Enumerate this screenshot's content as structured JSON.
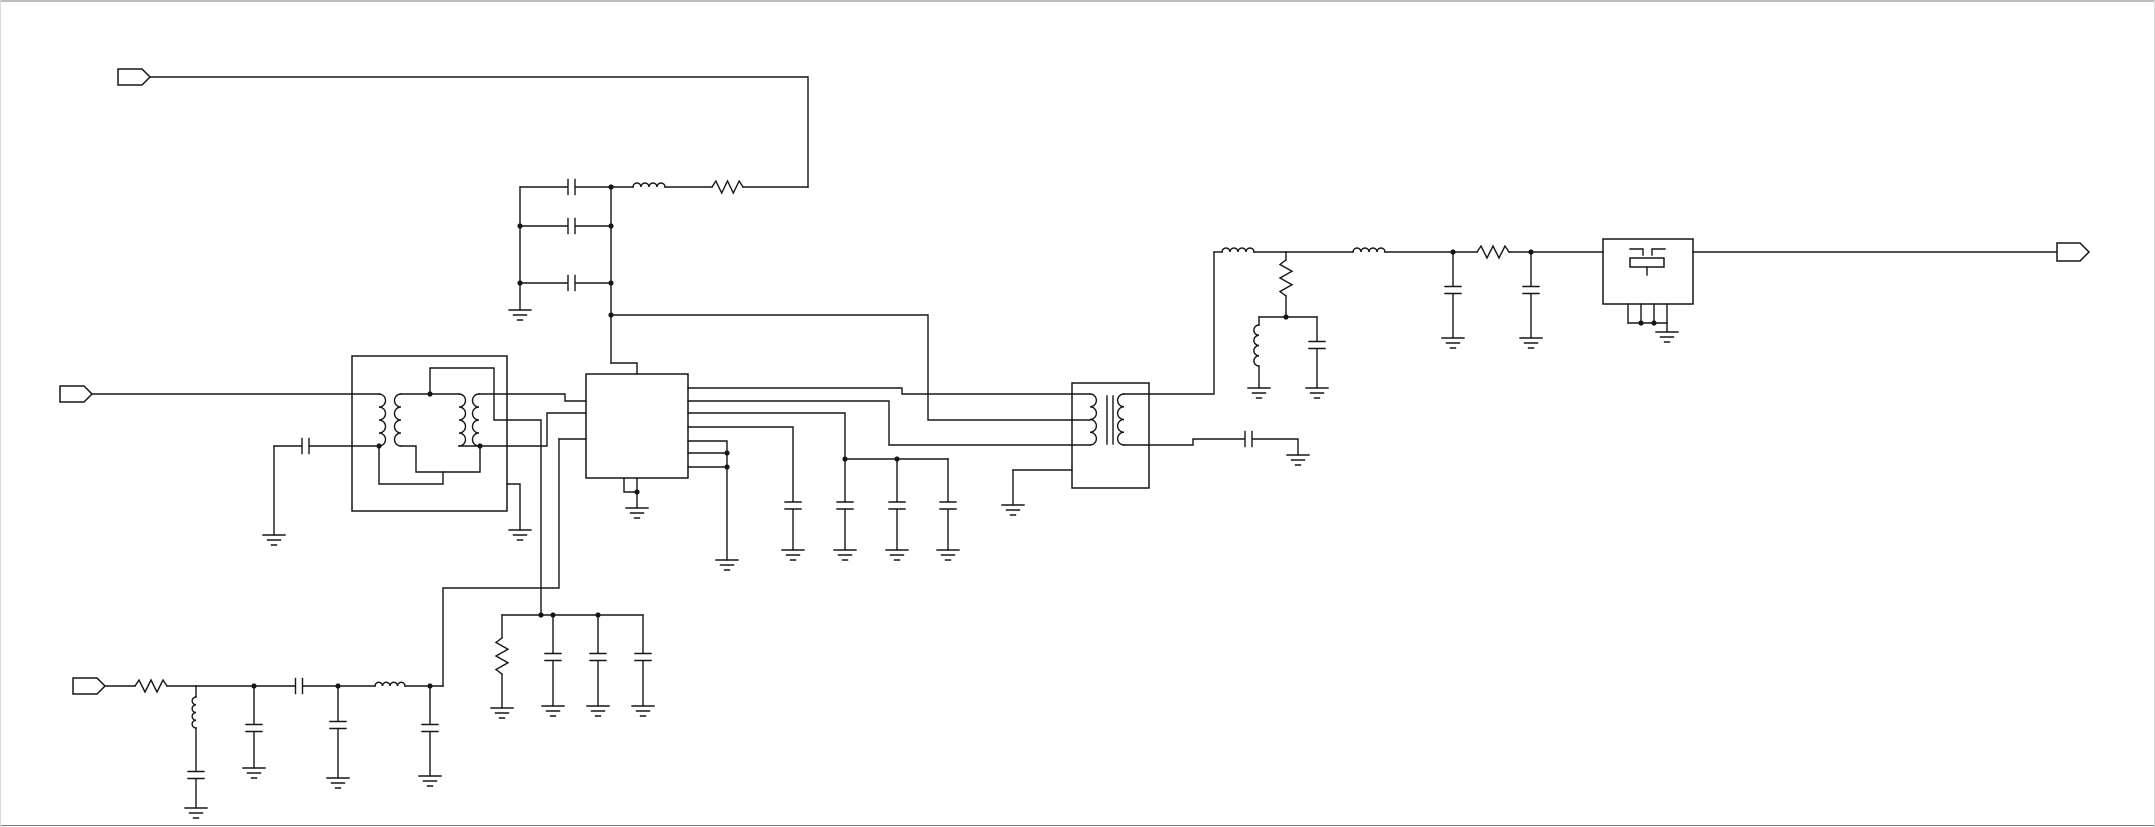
{
  "canvas": {
    "width": 2155,
    "height": 827,
    "background": "#ffffff",
    "line_color": "#161616"
  },
  "frame": {
    "top_color": "#7a7a7a",
    "bottom_color": "#7a7a7a",
    "side_color": "#d8d8d8",
    "lines": [
      {
        "name": "window-top-edge",
        "x1": 0,
        "y1": 1,
        "x2": 2155,
        "y2": 1,
        "color": "#7a7a7a"
      },
      {
        "name": "window-bottom-edge",
        "x1": 0,
        "y1": 825.5,
        "x2": 2155,
        "y2": 825.5,
        "color": "#7a7a7a"
      },
      {
        "name": "window-left-edge",
        "x1": 0.5,
        "y1": 0,
        "x2": 0.5,
        "y2": 827,
        "color": "#d8d8d8"
      },
      {
        "name": "window-right-edge",
        "x1": 2154.5,
        "y1": 0,
        "x2": 2154.5,
        "y2": 827,
        "color": "#d8d8d8"
      }
    ]
  },
  "schematic": {
    "ports": [
      {
        "name": "port-top-left",
        "x": 118,
        "cy": 77,
        "w": 32,
        "h": 16,
        "tip": 8
      },
      {
        "name": "port-mid-left",
        "x": 60,
        "cy": 394,
        "w": 32,
        "h": 16,
        "tip": 8
      },
      {
        "name": "port-bottom-left",
        "x": 73,
        "cy": 686,
        "w": 32,
        "h": 16,
        "tip": 8
      },
      {
        "name": "port-output-right",
        "x": 2057,
        "cy": 252,
        "w": 32,
        "h": 18,
        "tip": 9
      }
    ],
    "boxes": [
      {
        "name": "balun-transformer-box",
        "x": 352,
        "y": 356,
        "w": 155,
        "h": 155
      },
      {
        "name": "ic-box",
        "x": 586,
        "y": 374,
        "w": 102,
        "h": 104
      },
      {
        "name": "rf-transformer-box",
        "x": 1072,
        "y": 383,
        "w": 77,
        "h": 105
      },
      {
        "name": "saw-filter-box",
        "x": 1603,
        "y": 239,
        "w": 90,
        "h": 65
      }
    ],
    "wires": [
      [
        150,
        77,
        808,
        77,
        808,
        187
      ],
      [
        743,
        187,
        808,
        187
      ],
      [
        665,
        187,
        712,
        187
      ],
      [
        575.5,
        187,
        633,
        187
      ],
      [
        520,
        187,
        567.5,
        187
      ],
      [
        520,
        187,
        520,
        310
      ],
      [
        611,
        187,
        611,
        363
      ],
      [
        520,
        226,
        567.5,
        226
      ],
      [
        575.5,
        226,
        611,
        226
      ],
      [
        520,
        283,
        567.5,
        283
      ],
      [
        575.5,
        283,
        611,
        283
      ],
      [
        611,
        315,
        928,
        315,
        928,
        420,
        1090,
        420
      ],
      [
        611,
        363,
        637,
        363,
        637,
        374
      ],
      [
        92,
        394,
        379,
        394
      ],
      [
        401,
        394,
        459,
        394
      ],
      [
        430,
        394,
        430,
        368,
        494,
        368,
        494,
        420,
        541,
        420,
        541,
        615
      ],
      [
        479,
        394,
        565,
        394,
        565,
        401,
        586,
        401
      ],
      [
        274,
        446,
        301.5,
        446
      ],
      [
        309.5,
        446,
        379,
        446
      ],
      [
        274,
        446,
        274,
        535
      ],
      [
        379,
        446,
        379,
        484,
        443,
        484,
        443,
        472
      ],
      [
        401,
        446,
        416,
        446,
        416,
        472,
        480,
        472,
        480,
        446
      ],
      [
        459,
        446,
        480,
        446
      ],
      [
        480,
        446,
        547,
        446,
        547,
        413,
        586,
        413
      ],
      [
        507,
        484,
        520,
        484,
        520,
        530
      ],
      [
        559,
        439,
        586,
        439
      ],
      [
        559,
        439,
        559,
        588,
        443,
        588,
        443,
        686
      ],
      [
        624,
        478,
        624,
        492,
        637,
        492
      ],
      [
        637,
        478,
        637,
        508
      ],
      [
        688,
        388,
        902,
        388,
        902,
        394,
        1090,
        394
      ],
      [
        688,
        401,
        889,
        401,
        889,
        445,
        1090,
        445
      ],
      [
        688,
        413,
        845,
        413,
        845,
        459
      ],
      [
        845,
        459,
        948,
        459
      ],
      [
        845,
        459,
        845,
        501.5
      ],
      [
        845,
        509.5,
        845,
        550
      ],
      [
        897,
        459,
        897,
        501.5
      ],
      [
        897,
        509.5,
        897,
        550
      ],
      [
        948,
        459,
        948,
        501.5
      ],
      [
        948,
        509.5,
        948,
        550
      ],
      [
        688,
        427,
        793,
        427,
        793,
        501.5
      ],
      [
        793,
        509.5,
        793,
        550
      ],
      [
        688,
        441,
        727,
        441,
        727,
        560
      ],
      [
        688,
        453,
        727,
        453
      ],
      [
        688,
        467,
        727,
        467
      ],
      [
        105,
        686,
        135,
        686
      ],
      [
        167,
        686,
        196,
        686
      ],
      [
        196,
        686,
        196,
        697
      ],
      [
        196,
        728,
        196,
        771
      ],
      [
        196,
        779,
        196,
        808
      ],
      [
        196,
        686,
        254,
        686,
        295,
        686
      ],
      [
        303,
        686,
        338,
        686,
        375,
        686
      ],
      [
        405,
        686,
        443,
        686
      ],
      [
        254,
        686,
        254,
        724
      ],
      [
        254,
        732,
        254,
        768
      ],
      [
        338,
        686,
        338,
        721
      ],
      [
        338,
        729,
        338,
        778
      ],
      [
        430,
        686,
        430,
        724
      ],
      [
        430,
        732,
        430,
        776
      ],
      [
        502,
        615,
        643,
        615
      ],
      [
        502,
        615,
        502,
        638
      ],
      [
        502,
        674,
        502,
        708
      ],
      [
        553,
        615,
        553,
        653
      ],
      [
        553,
        661,
        553,
        706
      ],
      [
        598,
        615,
        598,
        653
      ],
      [
        598,
        661,
        598,
        706
      ],
      [
        643,
        615,
        643,
        653
      ],
      [
        643,
        661,
        643,
        706
      ],
      [
        1124,
        394,
        1214,
        394,
        1214,
        252
      ],
      [
        1124,
        445,
        1193,
        445,
        1193,
        439,
        1244.5,
        439
      ],
      [
        1252.5,
        439,
        1298,
        439,
        1298,
        455
      ],
      [
        1013,
        470,
        1072,
        470
      ],
      [
        1013,
        470,
        1013,
        505
      ],
      [
        1214,
        252,
        1222,
        252
      ],
      [
        1254,
        252,
        1286,
        252
      ],
      [
        1286,
        252,
        1353,
        252
      ],
      [
        1385,
        252,
        1453,
        252
      ],
      [
        1453,
        252,
        1477,
        252
      ],
      [
        1509,
        252,
        1531,
        252
      ],
      [
        1531,
        252,
        1603,
        252
      ],
      [
        1286,
        252,
        1286,
        260
      ],
      [
        1286,
        296,
        1286,
        317
      ],
      [
        1259,
        317,
        1317,
        317
      ],
      [
        1259,
        317,
        1259,
        325
      ],
      [
        1259,
        366,
        1259,
        388
      ],
      [
        1317,
        317,
        1317,
        341
      ],
      [
        1317,
        349,
        1317,
        388
      ],
      [
        1453,
        252,
        1453,
        286
      ],
      [
        1453,
        294,
        1453,
        338
      ],
      [
        1531,
        252,
        1531,
        286
      ],
      [
        1531,
        294,
        1531,
        338
      ],
      [
        1693,
        252,
        2057,
        252
      ],
      [
        1628,
        304,
        1628,
        323
      ],
      [
        1641,
        304,
        1641,
        323
      ],
      [
        1654,
        304,
        1654,
        323
      ],
      [
        1667,
        304,
        1667,
        323
      ],
      [
        1628,
        323,
        1667,
        323
      ],
      [
        1667,
        323,
        1667,
        332
      ]
    ],
    "resistors": [
      {
        "name": "resistor-top-filter",
        "x": 712,
        "y": 187,
        "len": 31,
        "o": "h"
      },
      {
        "name": "resistor-bottom-input",
        "x": 135,
        "y": 686,
        "len": 32,
        "o": "h"
      },
      {
        "name": "resistor-output-chain",
        "x": 1477,
        "y": 252,
        "len": 32,
        "o": "h"
      },
      {
        "name": "resistor-bias-bank",
        "x": 502,
        "y": 638,
        "len": 36,
        "o": "v"
      },
      {
        "name": "resistor-shunt-match",
        "x": 1286,
        "y": 260,
        "len": 36,
        "o": "v"
      }
    ],
    "inductors": [
      {
        "name": "inductor-top-filter",
        "x": 633,
        "y": 187,
        "len": 32,
        "o": "h"
      },
      {
        "name": "inductor-bottom-input",
        "x": 375,
        "y": 686,
        "len": 30,
        "o": "h"
      },
      {
        "name": "inductor-output-chain-1",
        "x": 1222,
        "y": 252,
        "len": 32,
        "o": "h"
      },
      {
        "name": "inductor-output-chain-2",
        "x": 1353,
        "y": 252,
        "len": 32,
        "o": "h"
      },
      {
        "name": "inductor-shunt-input",
        "x": 196,
        "y": 697,
        "len": 31,
        "o": "v"
      },
      {
        "name": "inductor-shunt-match",
        "x": 1259,
        "y": 325,
        "len": 41,
        "o": "v"
      }
    ],
    "capacitors": [
      {
        "name": "cap-bank-top-1",
        "x": 571.5,
        "y": 187,
        "o": "h"
      },
      {
        "name": "cap-bank-top-2",
        "x": 571.5,
        "y": 226,
        "o": "h"
      },
      {
        "name": "cap-bank-top-3",
        "x": 571.5,
        "y": 283,
        "o": "h"
      },
      {
        "name": "cap-balun-input",
        "x": 305.5,
        "y": 446,
        "o": "h"
      },
      {
        "name": "cap-series-bottom-input",
        "x": 299,
        "y": 686,
        "o": "h"
      },
      {
        "name": "cap-secondary-series",
        "x": 1248.5,
        "y": 439,
        "o": "h"
      },
      {
        "name": "cap-decouple-1",
        "x": 793,
        "y": 505.5,
        "o": "v"
      },
      {
        "name": "cap-decouple-2",
        "x": 845,
        "y": 505.5,
        "o": "v"
      },
      {
        "name": "cap-decouple-3",
        "x": 897,
        "y": 505.5,
        "o": "v"
      },
      {
        "name": "cap-decouple-4",
        "x": 948,
        "y": 505.5,
        "o": "v"
      },
      {
        "name": "cap-shunt-input-lc",
        "x": 196,
        "y": 775,
        "o": "v"
      },
      {
        "name": "cap-shunt-input-1",
        "x": 254,
        "y": 728,
        "o": "v"
      },
      {
        "name": "cap-shunt-input-2",
        "x": 338,
        "y": 725,
        "o": "v"
      },
      {
        "name": "cap-shunt-input-3",
        "x": 430,
        "y": 728,
        "o": "v"
      },
      {
        "name": "cap-bias-bank-1",
        "x": 553,
        "y": 657,
        "o": "v"
      },
      {
        "name": "cap-bias-bank-2",
        "x": 598,
        "y": 657,
        "o": "v"
      },
      {
        "name": "cap-bias-bank-3",
        "x": 643,
        "y": 657,
        "o": "v"
      },
      {
        "name": "cap-shunt-match",
        "x": 1317,
        "y": 345,
        "o": "v"
      },
      {
        "name": "cap-output-chain-1",
        "x": 1453,
        "y": 290,
        "o": "v"
      },
      {
        "name": "cap-output-chain-2",
        "x": 1531,
        "y": 290,
        "o": "v"
      }
    ],
    "windings": [
      {
        "name": "balun-winding-1",
        "x": 379,
        "y1": 394,
        "y2": 446,
        "bulge": "right"
      },
      {
        "name": "balun-winding-2",
        "x": 401,
        "y1": 394,
        "y2": 446,
        "bulge": "left"
      },
      {
        "name": "balun-winding-3",
        "x": 459,
        "y1": 394,
        "y2": 446,
        "bulge": "right"
      },
      {
        "name": "balun-winding-4",
        "x": 479,
        "y1": 394,
        "y2": 446,
        "bulge": "left"
      },
      {
        "name": "transformer-primary-winding",
        "x": 1090,
        "y1": 394,
        "y2": 445,
        "bulge": "right"
      },
      {
        "name": "transformer-secondary-winding",
        "x": 1124,
        "y1": 394,
        "y2": 445,
        "bulge": "left"
      }
    ],
    "core_lines": [
      {
        "name": "transformer-core-line-1",
        "x": 1107,
        "y1": 396,
        "y2": 444
      },
      {
        "name": "transformer-core-line-2",
        "x": 1113,
        "y1": 396,
        "y2": 444
      }
    ],
    "grounds": [
      {
        "x": 520,
        "y": 310
      },
      {
        "x": 274,
        "y": 535
      },
      {
        "x": 520,
        "y": 530
      },
      {
        "x": 637,
        "y": 508
      },
      {
        "x": 727,
        "y": 560
      },
      {
        "x": 793,
        "y": 550
      },
      {
        "x": 845,
        "y": 550
      },
      {
        "x": 897,
        "y": 550
      },
      {
        "x": 948,
        "y": 550
      },
      {
        "x": 196,
        "y": 808
      },
      {
        "x": 254,
        "y": 768
      },
      {
        "x": 338,
        "y": 778
      },
      {
        "x": 430,
        "y": 776
      },
      {
        "x": 502,
        "y": 708
      },
      {
        "x": 553,
        "y": 706
      },
      {
        "x": 598,
        "y": 706
      },
      {
        "x": 643,
        "y": 706
      },
      {
        "x": 1013,
        "y": 505
      },
      {
        "x": 1259,
        "y": 388
      },
      {
        "x": 1317,
        "y": 388
      },
      {
        "x": 1298,
        "y": 455
      },
      {
        "x": 1453,
        "y": 338
      },
      {
        "x": 1531,
        "y": 338
      },
      {
        "x": 1667,
        "y": 332
      }
    ],
    "dots": [
      [
        611,
        187
      ],
      [
        520,
        226
      ],
      [
        611,
        226
      ],
      [
        520,
        283
      ],
      [
        611,
        283
      ],
      [
        611,
        315
      ],
      [
        430,
        394
      ],
      [
        379,
        446
      ],
      [
        480,
        446
      ],
      [
        845,
        459
      ],
      [
        897,
        459
      ],
      [
        727,
        453
      ],
      [
        727,
        467
      ],
      [
        637,
        492
      ],
      [
        254,
        686
      ],
      [
        338,
        686
      ],
      [
        430,
        686
      ],
      [
        541,
        615
      ],
      [
        553,
        615
      ],
      [
        598,
        615
      ],
      [
        1286,
        317
      ],
      [
        1453,
        252
      ],
      [
        1531,
        252
      ],
      [
        1641,
        323
      ],
      [
        1654,
        323
      ]
    ],
    "saw_symbol": {
      "polylines": [
        {
          "name": "saw-idt-left",
          "pts": [
            [
              1630,
              249
            ],
            [
              1643,
              249
            ],
            [
              1643,
              255
            ]
          ]
        },
        {
          "name": "saw-idt-right",
          "pts": [
            [
              1652,
              255
            ],
            [
              1652,
              249
            ],
            [
              1665,
              249
            ]
          ]
        },
        {
          "name": "saw-stub",
          "pts": [
            [
              1647,
              267
            ],
            [
              1647,
              275
            ]
          ]
        }
      ],
      "rects": [
        {
          "name": "saw-resonator-rect",
          "x": 1630,
          "y": 258,
          "w": 34,
          "h": 9
        }
      ]
    }
  }
}
